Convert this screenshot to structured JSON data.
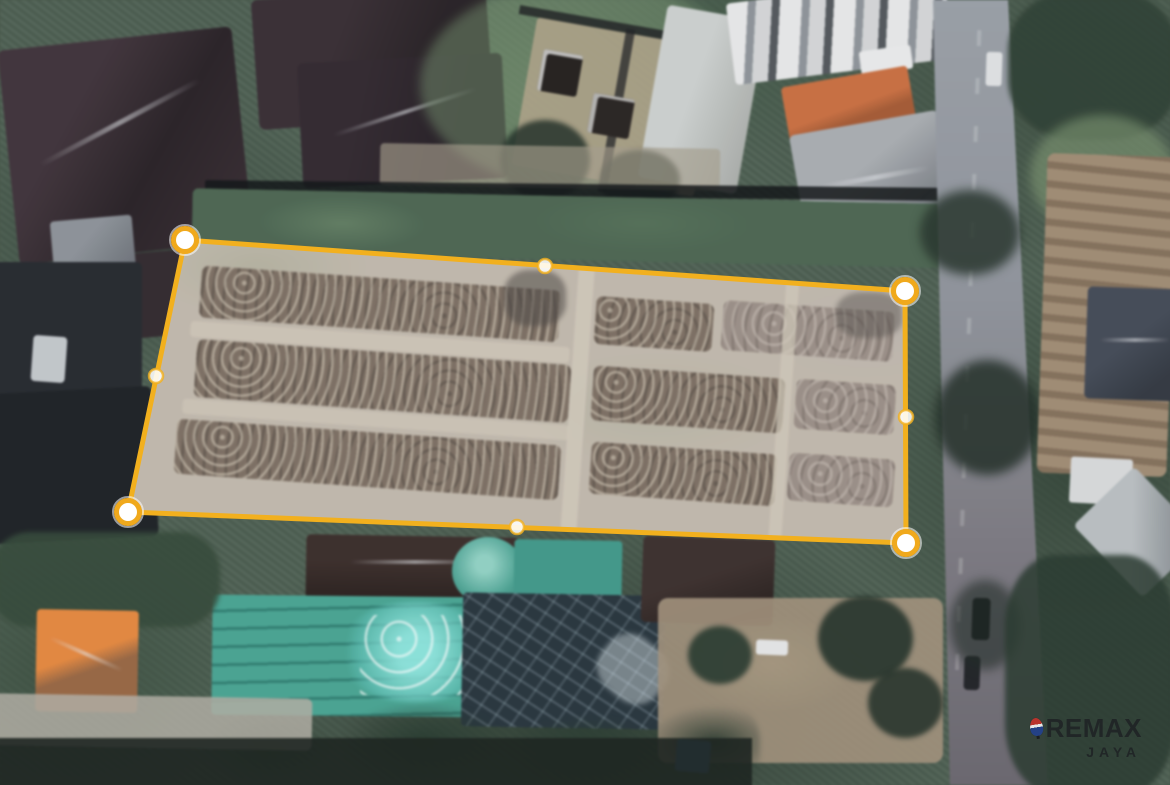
{
  "overlay": {
    "accent_color": "#F2B01E",
    "handle_ring_color": "#F0A91C",
    "handle_fill_color": "#FFFFFF",
    "region_fill": "rgba(255,255,255,0.12)",
    "stroke_width": 5,
    "corner_handles": [
      [
        185,
        240
      ],
      [
        905,
        291
      ],
      [
        906,
        543
      ],
      [
        128,
        512
      ]
    ],
    "midpoint_handles": [
      [
        545,
        266
      ],
      [
        906,
        417
      ],
      [
        517,
        527
      ],
      [
        156,
        376
      ]
    ],
    "corner_radius": 11.5,
    "midpoint_radius": 7
  },
  "watermark": {
    "brand": "REMAX",
    "subtitle": "JAYA",
    "balloon": {
      "top_color": "#C5322C",
      "band_color": "#F4F4F4",
      "bottom_color": "#23418C"
    }
  }
}
